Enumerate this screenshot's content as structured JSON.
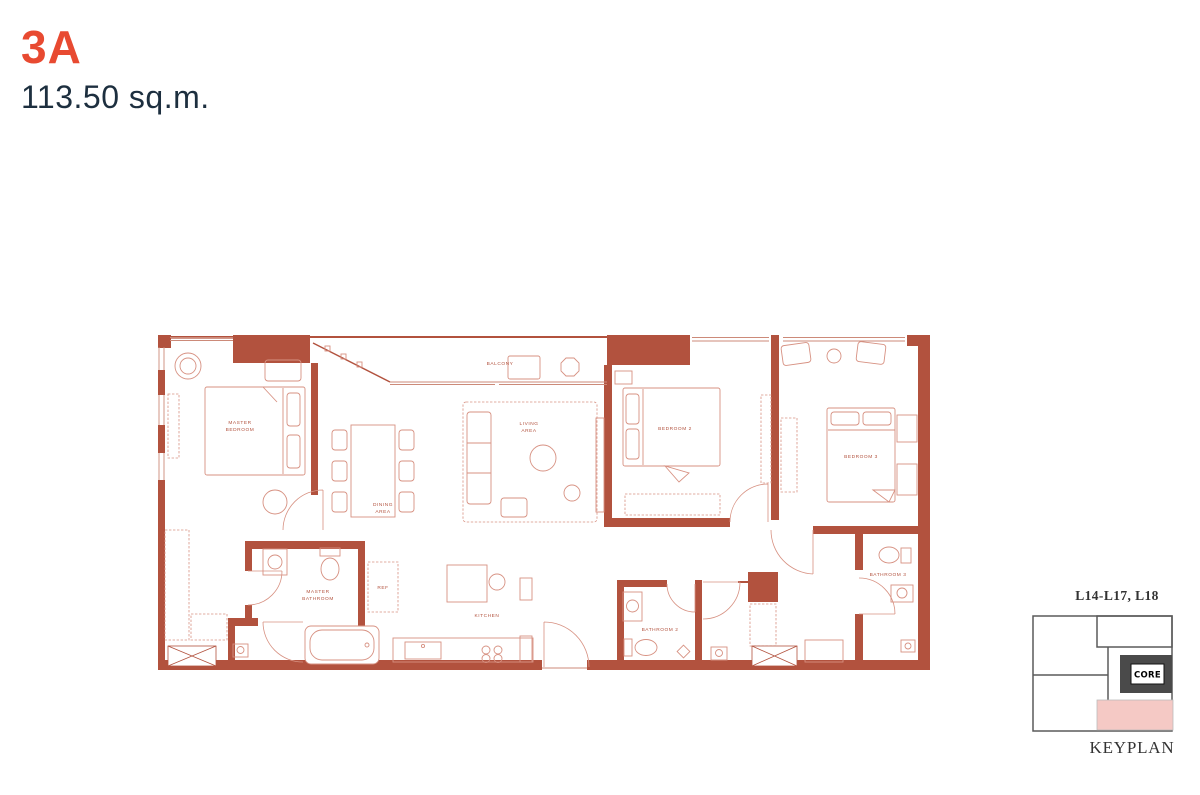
{
  "page": {
    "unit_name": "3A",
    "unit_area": "113.50 sq.m."
  },
  "colors": {
    "accent": "#e84a31",
    "heading": "#1d2f3f",
    "wall": "#b2523e",
    "furniture": "#d79182",
    "window": "#cc8a79",
    "keyplan_line": "#5a5a5a",
    "keyplan_core_bg": "#4a4a4a",
    "keyplan_pink": "#f5c9c5",
    "keyplan_text": "#333333"
  },
  "floorplan": {
    "labels": {
      "master_bedroom": [
        "MASTER",
        "BEDROOM"
      ],
      "balcony": "BALCONY",
      "dining_area": [
        "DINING",
        "AREA"
      ],
      "living_area": [
        "LIVING",
        "AREA"
      ],
      "bedroom_2": "BEDROOM 2",
      "bedroom_3": "BEDROOM 3",
      "master_bathroom": [
        "MASTER",
        "BATHROOM"
      ],
      "ref": "REF",
      "kitchen": "KITCHEN",
      "bathroom_2": "BATHROOM 2",
      "bathroom_3": "BATHROOM 3"
    }
  },
  "keyplan": {
    "levels": "L14-L17, L18",
    "core_label": "CORE",
    "caption": "KEYPLAN"
  }
}
